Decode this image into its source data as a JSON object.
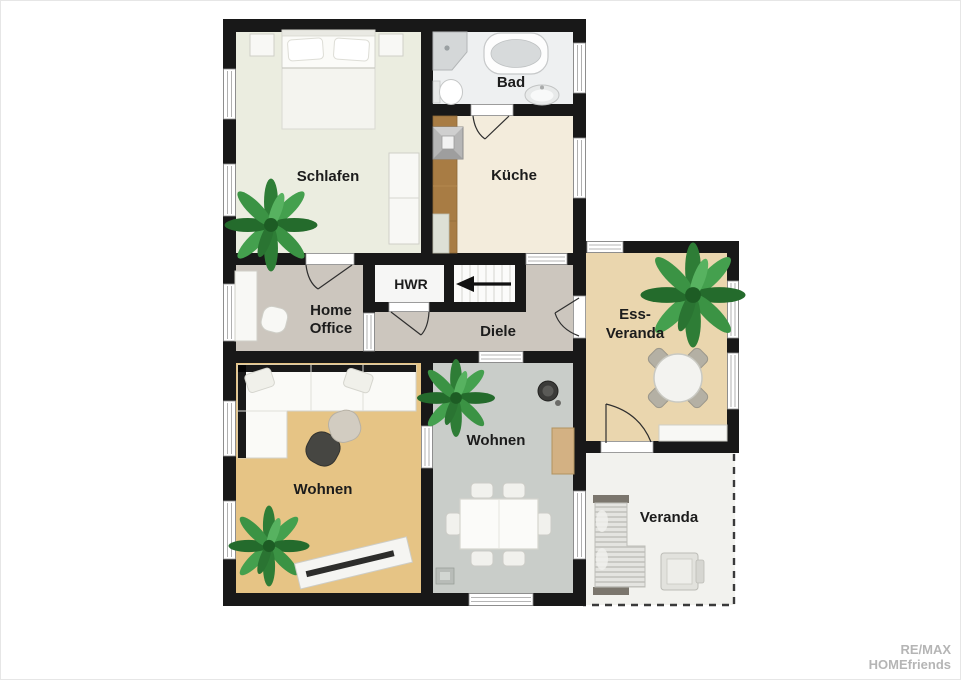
{
  "title": "Grundriss / floor plan",
  "rooms": {
    "schlafen": {
      "label": "Schlafen"
    },
    "bad": {
      "label": "Bad"
    },
    "kueche": {
      "label": "Küche"
    },
    "home_office": {
      "line1": "Home",
      "line2": "Office"
    },
    "hwr": {
      "label": "HWR"
    },
    "diele": {
      "label": "Diele"
    },
    "ess_veranda": {
      "line1": "Ess-",
      "line2": "Veranda"
    },
    "wohnen_left": {
      "label": "Wohnen"
    },
    "wohnen_center": {
      "label": "Wohnen"
    },
    "veranda": {
      "label": "Veranda"
    }
  },
  "watermark": {
    "line1": "RE/MAX",
    "line2": "HOMEfriends"
  },
  "colors": {
    "wall": "#181818",
    "floor_schlafen": "#ebede0",
    "floor_bad": "#eef0f1",
    "floor_kueche": "#f3ecdc",
    "floor_flur": "#ccc6be",
    "floor_hwr": "#f6f6f5",
    "floor_ess_veranda": "#ead6ae",
    "floor_wohnen_left": "#e6c485",
    "floor_wohnen_center": "#c9cdc9",
    "floor_veranda": "#f2f2ee",
    "wood_counter": "#a87c44",
    "plant_green": "#2f8038"
  }
}
